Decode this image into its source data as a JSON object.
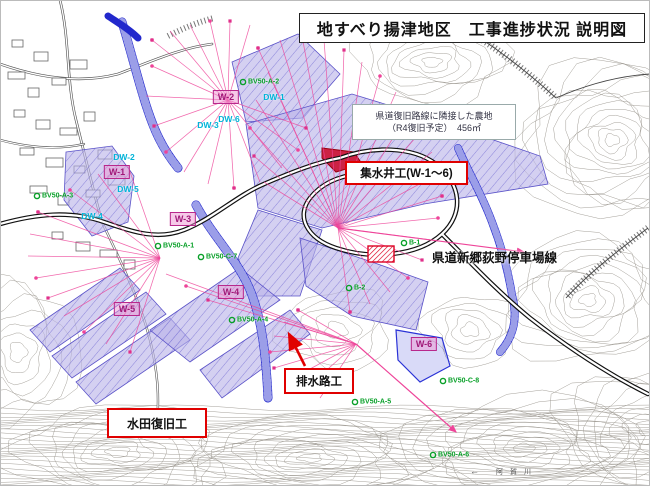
{
  "title": "地すべり揚津地区　工事進捗状況 説明図",
  "farmland_note": {
    "line1": "県道復旧路線に隣接した農地",
    "line2": "（R4復旧予定）　456㎡"
  },
  "callouts": {
    "collection_wells": "集水井工(W-1〜6)",
    "prefectural_road": "県道新郷荻野停車場線",
    "drainage_channel": "排水路工",
    "paddy_restoration": "水田復旧工"
  },
  "wells": [
    {
      "id": "W-1",
      "x": 117,
      "y": 172
    },
    {
      "id": "W-2",
      "x": 226,
      "y": 97
    },
    {
      "id": "W-3",
      "x": 183,
      "y": 219
    },
    {
      "id": "W-4",
      "x": 231,
      "y": 292
    },
    {
      "id": "W-5",
      "x": 127,
      "y": 309
    },
    {
      "id": "W-6",
      "x": 424,
      "y": 344
    }
  ],
  "drain_wells": [
    {
      "id": "DW-1",
      "x": 274,
      "y": 97
    },
    {
      "id": "DW-2",
      "x": 124,
      "y": 157
    },
    {
      "id": "DW-3",
      "x": 208,
      "y": 125
    },
    {
      "id": "DW-4",
      "x": 92,
      "y": 216
    },
    {
      "id": "DW-5",
      "x": 128,
      "y": 189
    },
    {
      "id": "DW-6",
      "x": 229,
      "y": 119
    }
  ],
  "boreholes": [
    {
      "id": "BV50-A-1",
      "x": 163,
      "y": 246
    },
    {
      "id": "BV50-A-2",
      "x": 248,
      "y": 82
    },
    {
      "id": "BV50-A-3",
      "x": 42,
      "y": 196
    },
    {
      "id": "BV50-A-4",
      "x": 237,
      "y": 320
    },
    {
      "id": "BV50-A-5",
      "x": 360,
      "y": 402
    },
    {
      "id": "BV50-A-6",
      "x": 438,
      "y": 455
    },
    {
      "id": "BV50-C-7",
      "x": 206,
      "y": 257
    },
    {
      "id": "BV50-C-8",
      "x": 448,
      "y": 381
    },
    {
      "id": "B-1",
      "x": 409,
      "y": 243
    },
    {
      "id": "B-2",
      "x": 354,
      "y": 288
    }
  ],
  "river": {
    "name": "阿賀川",
    "flow_arrow": "←"
  },
  "colors": {
    "callout_border": "#e00000",
    "well_label": "#a01878",
    "dw_label": "#00b4d8",
    "borehole_label": "#08a028",
    "survey_line": "#ee4499",
    "stream": "#2228cc",
    "paddy_fill": "#b9b3e9",
    "farmland_fill": "#cc2244",
    "contour": "#9a958d"
  }
}
